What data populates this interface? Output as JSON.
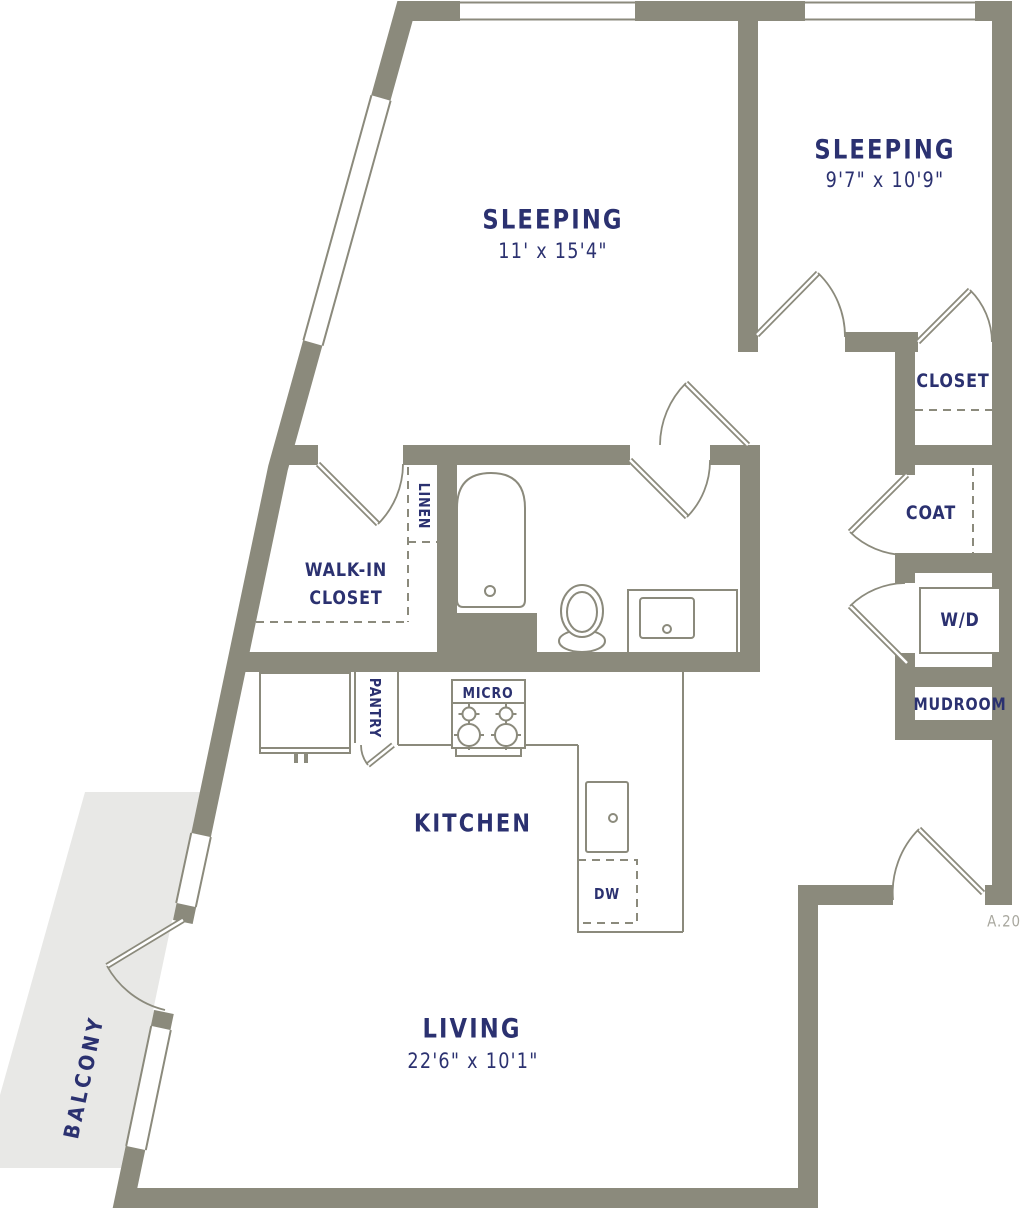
{
  "colors": {
    "wall": "#8b8a7c",
    "navy": "#2b3170",
    "balcony": "#e8e8e6",
    "ref": "#a9a89f"
  },
  "sheet_ref": "A.20",
  "rooms": {
    "sleeping_main": {
      "label": "SLEEPING",
      "dims": "11' x 15'4\""
    },
    "sleeping_second": {
      "label": "SLEEPING",
      "dims": "9'7\" x 10'9\""
    },
    "living": {
      "label": "LIVING",
      "dims": "22'6\" x 10'1\""
    },
    "kitchen": {
      "label": "KITCHEN"
    },
    "balcony": {
      "label": "BALCONY"
    },
    "walk_in_closet": {
      "line1": "WALK-IN",
      "line2": "CLOSET"
    },
    "closet": {
      "label": "CLOSET"
    },
    "coat": {
      "label": "COAT"
    },
    "mudroom": {
      "label": "MUDROOM"
    },
    "linen": {
      "label": "LINEN"
    },
    "pantry": {
      "label": "PANTRY"
    }
  },
  "fixtures": {
    "washer_dryer": "W/D",
    "microwave": "MICRO",
    "dishwasher": "DW"
  }
}
